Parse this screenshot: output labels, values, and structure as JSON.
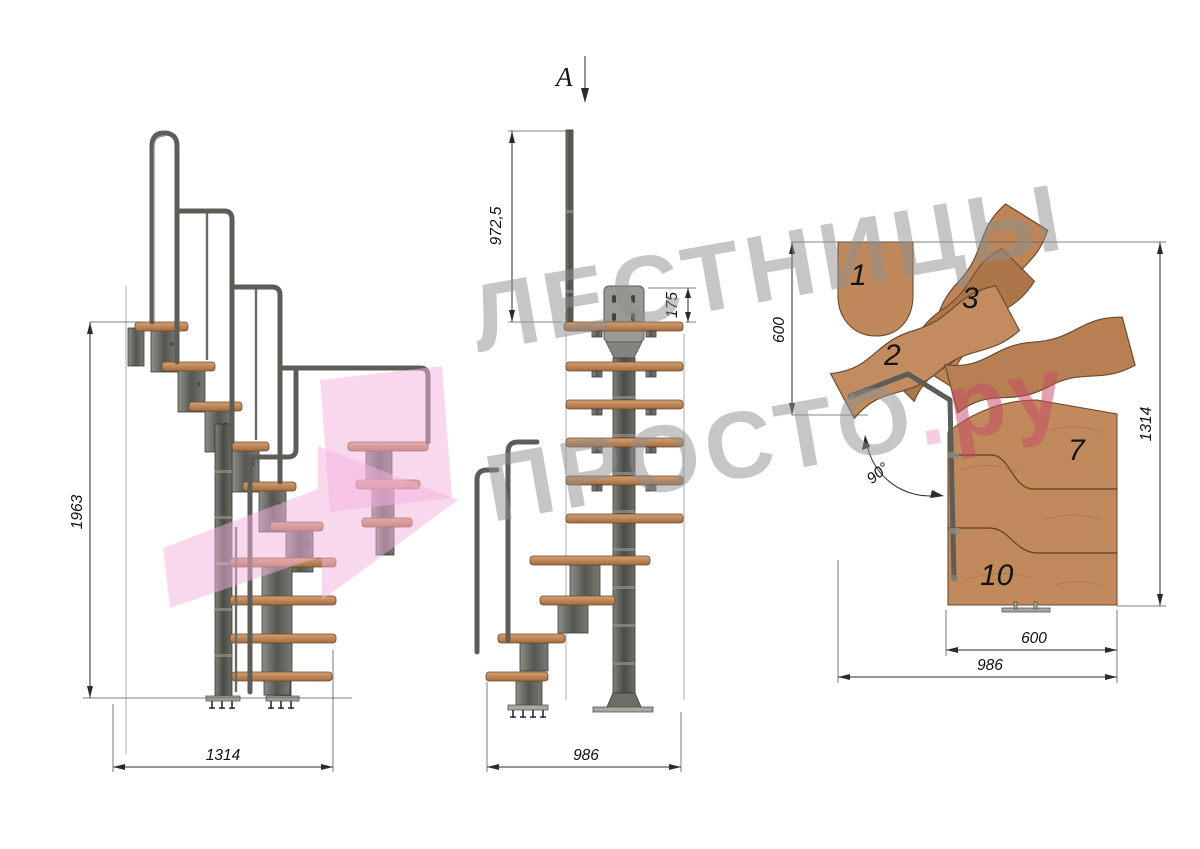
{
  "title": "Модульная лестница — чертёж (3 вида)",
  "section_marker": {
    "label": "A"
  },
  "watermark": {
    "line1": "ЛЕСТНИЦЫ",
    "line2": "ПРОСТО",
    "dot": ".",
    "suffix": "ру"
  },
  "views": {
    "side": {
      "name": "боковой вид",
      "dims": {
        "height": "1963",
        "length": "1314"
      }
    },
    "front": {
      "name": "фронтальный вид",
      "dims": {
        "rail_height": "972,5",
        "plate": "175",
        "length": "986"
      }
    },
    "plan": {
      "name": "вид сверху",
      "dims": {
        "upper_width": "600",
        "total_length": "1314",
        "lower_width": "600",
        "overall": "986",
        "angle": "90°"
      },
      "steps": {
        "s1": "1",
        "s2": "2",
        "s3": "3",
        "s7": "7",
        "s10": "10"
      }
    }
  },
  "colors": {
    "wood": "#c18a5d",
    "wood_dark": "#ad7649",
    "metal": "#5d5c57",
    "dimension": "#2b2b2b",
    "watermark_gray": "#8f8f8f",
    "watermark_pink": "#f3b2de",
    "suffix_crimson": "#c74868",
    "dot_pink": "#ea9cc6"
  }
}
